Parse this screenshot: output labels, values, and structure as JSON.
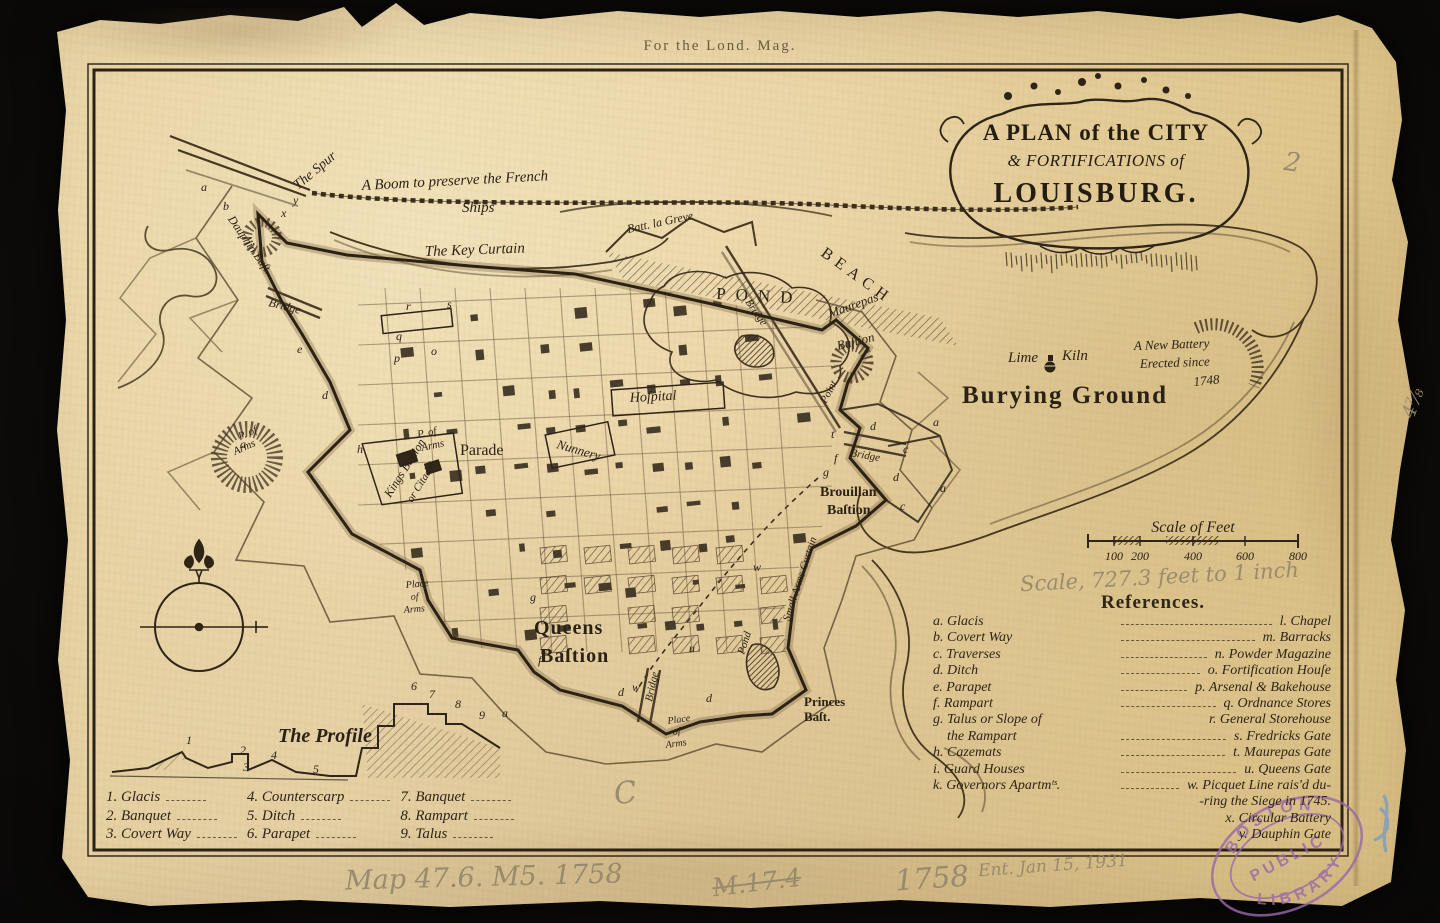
{
  "page": {
    "imprint": "For the Lond. Mag."
  },
  "cartouche": {
    "line1": "A PLAN of the CITY",
    "line2": "& FORTIFICATIONS of",
    "line3": "LOUISBURG."
  },
  "map_labels": {
    "spur": "The Spur",
    "boom_line1": "A Boom to preserve the French",
    "boom_line2": "Ships",
    "key_curtain": "The Key Curtain",
    "batt_la_greve": "Batt. la Greve",
    "beach": "BEACH",
    "pond": "POND",
    "bridge_pond": "Bridge",
    "maurepas_1": "Maurepas",
    "maurepas_2": "Baſtion",
    "point": "Point",
    "lime_1": "Lime",
    "lime_2": "Kiln",
    "new_battery_1": "A New Battery",
    "new_battery_2": "Erected since",
    "new_battery_3": "1748",
    "burying_ground": "Burying Ground",
    "bridge_east": "Bridge",
    "hospital": "Hoſpital",
    "parade": "Parade",
    "nunnery": "Nunnery",
    "p_arms_c1": "P. of",
    "p_arms_c2": "Arms",
    "p_arms_w1": "P. of",
    "p_arms_w2": "Arms",
    "kings_1": "Kings Baſtion",
    "kings_2": "or Citadel",
    "dauphin": "Dauphin Baſt.",
    "bridge_west": "Bridge",
    "queens_1": "Queens",
    "queens_2": "Baſtion",
    "brouillan_1": "Brouillan",
    "brouillan_2": "Baſtion",
    "princes_1": "Princes",
    "princes_2": "Baſt.",
    "place_s1": "Place",
    "place_s2": "of",
    "place_s3": "Arms",
    "place_w1": "Place",
    "place_w2": "of",
    "place_w3": "Arms",
    "small_arms": "Small Arms Curtain",
    "pond_small": "Pond",
    "bridge_south": "Bridge",
    "profile_title": "The Profile"
  },
  "letters": [
    {
      "t": "a",
      "x": 201,
      "y": 191
    },
    {
      "t": "b",
      "x": 223,
      "y": 210
    },
    {
      "t": "y",
      "x": 293,
      "y": 204
    },
    {
      "t": "x",
      "x": 281,
      "y": 217
    },
    {
      "t": "e",
      "x": 297,
      "y": 353
    },
    {
      "t": "d",
      "x": 322,
      "y": 399
    },
    {
      "t": "r",
      "x": 406,
      "y": 310
    },
    {
      "t": "s",
      "x": 447,
      "y": 308
    },
    {
      "t": "q",
      "x": 396,
      "y": 340
    },
    {
      "t": "p",
      "x": 394,
      "y": 362
    },
    {
      "t": "o",
      "x": 431,
      "y": 355
    },
    {
      "t": "a",
      "x": 240,
      "y": 448
    },
    {
      "t": "h",
      "x": 357,
      "y": 453
    },
    {
      "t": "g",
      "x": 530,
      "y": 601
    },
    {
      "t": "f",
      "x": 538,
      "y": 664
    },
    {
      "t": "a",
      "x": 502,
      "y": 717
    },
    {
      "t": "d",
      "x": 618,
      "y": 696
    },
    {
      "t": "u",
      "x": 689,
      "y": 652
    },
    {
      "t": "d",
      "x": 706,
      "y": 702
    },
    {
      "t": "t",
      "x": 831,
      "y": 438
    },
    {
      "t": "g",
      "x": 823,
      "y": 476
    },
    {
      "t": "c",
      "x": 903,
      "y": 453
    },
    {
      "t": "a",
      "x": 933,
      "y": 426
    },
    {
      "t": "d",
      "x": 893,
      "y": 481
    },
    {
      "t": "w",
      "x": 753,
      "y": 571
    },
    {
      "t": "w",
      "x": 632,
      "y": 691
    },
    {
      "t": "c",
      "x": 900,
      "y": 510
    },
    {
      "t": "a",
      "x": 940,
      "y": 492
    },
    {
      "t": "f",
      "x": 834,
      "y": 462
    },
    {
      "t": "d",
      "x": 870,
      "y": 430
    }
  ],
  "scale_bar": {
    "title": "Scale of Feet",
    "ticks": [
      "100",
      "200",
      "400",
      "600",
      "800"
    ]
  },
  "references": {
    "heading": "References.",
    "rows": [
      {
        "l": "a. Glacis",
        "r": "l. Chapel"
      },
      {
        "l": "b. Covert Way",
        "r": "m. Barracks"
      },
      {
        "l": "c. Traverses",
        "r": "n. Powder Magazine"
      },
      {
        "l": "d. Ditch",
        "r": "o. Fortification Houſe"
      },
      {
        "l": "e. Parapet",
        "r": "p. Arsenal & Bakehouse"
      },
      {
        "l": "f. Rampart",
        "r": "q. Ordnance Stores"
      },
      {
        "l": "g. Talus or Slope of",
        "r": "r. General Storehouse"
      },
      {
        "l": "    the Rampart",
        "r": "s. Fredricks Gate"
      },
      {
        "l": "h. Cazemats",
        "r": "t. Maurepas Gate"
      },
      {
        "l": "i. Guard Houses",
        "r": "u. Queens Gate"
      },
      {
        "l": "k. Governors Apartmᵗˢ.",
        "r": "w. Picquet Line rais'd du-"
      },
      {
        "l": "",
        "r": "    -ring the Siege in 1745."
      },
      {
        "l": "",
        "r": "x. Circular Battery"
      },
      {
        "l": "",
        "r": "y. Dauphin Gate"
      }
    ]
  },
  "profile": {
    "numbers": [
      {
        "n": "1",
        "x": 186,
        "y": 744
      },
      {
        "n": "2",
        "x": 240,
        "y": 754
      },
      {
        "n": "3",
        "x": 243,
        "y": 771
      },
      {
        "n": "4",
        "x": 271,
        "y": 759
      },
      {
        "n": "5",
        "x": 313,
        "y": 773
      },
      {
        "n": "6",
        "x": 411,
        "y": 690
      },
      {
        "n": "7",
        "x": 429,
        "y": 698
      },
      {
        "n": "8",
        "x": 455,
        "y": 708
      },
      {
        "n": "9",
        "x": 479,
        "y": 719
      }
    ],
    "legend": [
      [
        "1. Glacis",
        "2. Banquet",
        "3. Covert Way"
      ],
      [
        "4. Counterscarp",
        "5. Ditch",
        "6. Parapet"
      ],
      [
        "7. Banquet",
        "8. Rampart",
        "9. Talus"
      ]
    ]
  },
  "annotations": {
    "pencil_scale": "Scale, 727.3 feet to 1 inch",
    "shelfmark": "Map 47.6. M5. 1758",
    "crossed": "M.17.4",
    "year": "1758",
    "accession": "Ent. Jan 15, 1931",
    "mark_two": "2",
    "mark_c": "C",
    "edge_mark": "4⅞"
  },
  "stamp": {
    "line1": "BOSTON",
    "line2": "PUBLIC",
    "line3": "LIBRARY"
  },
  "colors": {
    "paper": "#e9d5a6",
    "ink": "#2b2115",
    "engraving": "#4a3a26",
    "pencil": "#94876a",
    "stamp": "#9a68a8",
    "blue": "#5f93d6",
    "background": "#0a0908"
  }
}
